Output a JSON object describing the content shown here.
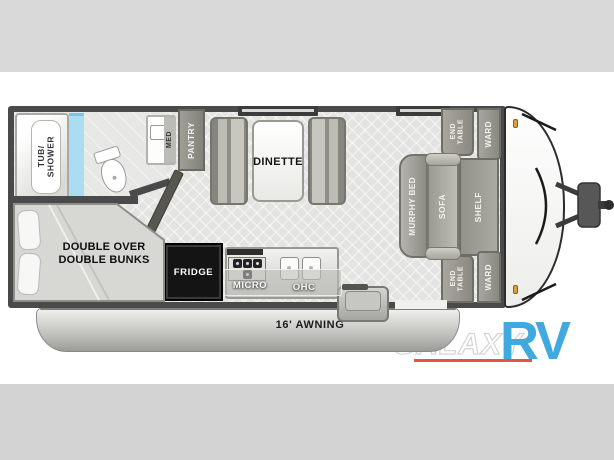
{
  "plan": {
    "bathroom": {
      "tub_shower": "TUB/\nSHOWER",
      "med": "MED"
    },
    "kitchen": {
      "pantry": "PANTRY",
      "fridge": "FRIDGE",
      "micro": "MICRO",
      "ohc": "OHC"
    },
    "dinette": "DINETTE",
    "bunks": "DOUBLE OVER\nDOUBLE BUNKS",
    "front_bedroom": {
      "murphy_bed": "MURPHY BED",
      "sofa": "SOFA",
      "shelf": "SHELF",
      "end_table_top": "END\nTABLE",
      "ward_top": "WARD",
      "end_table_bottom": "END\nTABLE",
      "ward_bottom": "WARD"
    },
    "awning": "16' AWNING"
  },
  "logo": {
    "brand": "GALAXY",
    "suffix": "RV"
  },
  "colors": {
    "wall": "#4a4a4a",
    "floor": "#e3e3e1",
    "furniture_gray": "#928f88",
    "shower_glass": "#a9ddf1",
    "marker_light": "#dd9f38",
    "logo_blue": "#3fa9e0",
    "logo_underline_red": "#e0564a",
    "band_gray": "#d9d9d9"
  }
}
